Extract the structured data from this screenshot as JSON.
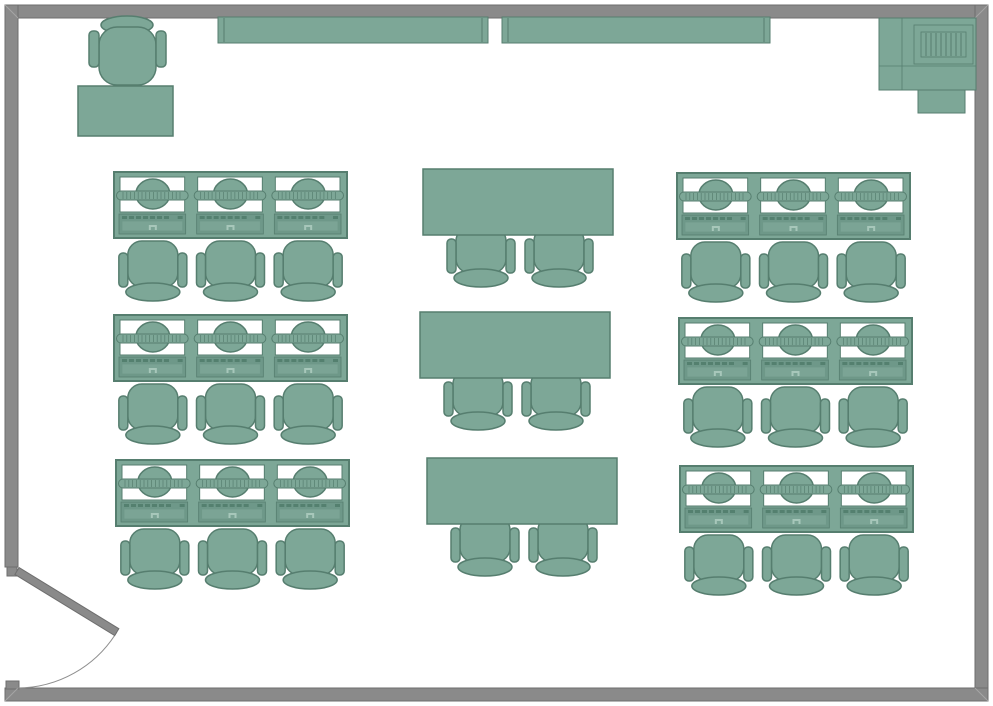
{
  "diagram": {
    "type": "floor-plan",
    "name": "computer-classroom-floor-plan"
  },
  "canvas": {
    "width": 993,
    "height": 706,
    "background": "#ffffff"
  },
  "colors": {
    "furniture_fill": "#7DA797",
    "furniture_stroke": "#567E6F",
    "keyboard_fill": "#6E9889",
    "keyboard_inner_fill": "#7BA495",
    "key_dash": "#54806F",
    "mouse_glyph": "#A7C7BA",
    "monitor_white": "#FFFFFF",
    "wall_fill": "#8A8A8A",
    "wall_stroke": "#6E6E6E",
    "wall_miter": "#A5A5A5",
    "swing_arc": "#8F8F8F"
  },
  "room": {
    "walls": [
      {
        "name": "wall-top",
        "x": 5,
        "y": 5,
        "w": 983,
        "h": 13
      },
      {
        "name": "wall-left",
        "x": 5,
        "y": 5,
        "w": 13,
        "h": 562
      },
      {
        "name": "wall-right",
        "x": 975,
        "y": 5,
        "w": 13,
        "h": 696
      },
      {
        "name": "wall-bottom",
        "x": 5,
        "y": 688,
        "w": 983,
        "h": 13
      }
    ],
    "jambs": [
      {
        "name": "door-jamb-top",
        "x": 7,
        "y": 567,
        "w": 10,
        "h": 9
      },
      {
        "name": "door-jamb-bottom",
        "x": 6,
        "y": 681,
        "w": 13,
        "h": 8
      }
    ],
    "miters": [
      {
        "x1": 5,
        "y1": 5,
        "x2": 18,
        "y2": 18
      },
      {
        "x1": 988,
        "y1": 5,
        "x2": 975,
        "y2": 18
      },
      {
        "x1": 988,
        "y1": 701,
        "x2": 975,
        "y2": 688
      },
      {
        "x1": 5,
        "y1": 701,
        "x2": 18,
        "y2": 688
      }
    ]
  },
  "door": {
    "hinge_x": 17,
    "hinge_y": 571,
    "length": 117,
    "thickness": 8,
    "angle_deg": 31.5
  },
  "whiteboards": [
    {
      "x": 218,
      "y": 17,
      "w": 270,
      "h": 26,
      "end_inset": 6
    },
    {
      "x": 502,
      "y": 17,
      "w": 268,
      "h": 26,
      "end_inset": 6
    }
  ],
  "printer": {
    "body": {
      "x": 879,
      "y": 18,
      "w": 97,
      "h": 72
    },
    "divider_x": 902,
    "divider_y": 66,
    "grille_outer": {
      "x": 914,
      "y": 25,
      "w": 59,
      "h": 39
    },
    "grille_inner": {
      "x": 921,
      "y": 32,
      "w": 45,
      "h": 25
    },
    "grille_stripes": 8,
    "tab": {
      "x": 918,
      "y": 90,
      "w": 47,
      "h": 23
    }
  },
  "teacher_station": {
    "chair": {
      "back": {
        "cx": 127,
        "cy": 25,
        "rx": 26,
        "ry": 9
      },
      "seat": {
        "x": 99,
        "y": 27,
        "w": 57,
        "h": 58,
        "r": 18
      },
      "arm_left": {
        "x": 89,
        "y": 31,
        "w": 10,
        "h": 36
      },
      "arm_right": {
        "x": 156,
        "y": 31,
        "w": 10,
        "h": 36
      }
    },
    "desk": {
      "x": 78,
      "y": 86,
      "w": 95,
      "h": 50
    }
  },
  "computer_desks": {
    "desk_w": 233,
    "desk_h": 66,
    "stations": 3,
    "rows": [
      {
        "x": 114,
        "y": 172
      },
      {
        "x": 114,
        "y": 315
      },
      {
        "x": 116,
        "y": 460
      },
      {
        "x": 677,
        "y": 173
      },
      {
        "x": 679,
        "y": 318
      },
      {
        "x": 680,
        "y": 466
      }
    ]
  },
  "tables": {
    "w": 190,
    "h": 66,
    "chair_center_offsets": [
      58,
      136
    ],
    "rows": [
      {
        "x": 423,
        "y": 169
      },
      {
        "x": 420,
        "y": 312
      },
      {
        "x": 427,
        "y": 458
      }
    ]
  },
  "chair_geometry": {
    "seat_w": 50,
    "seat_h": 46,
    "seat_r": 14,
    "arm_w": 9,
    "arm_h": 34,
    "arm_r": 4,
    "back_rx": 27,
    "back_ry": 9,
    "gap_below_desk": 3,
    "table_overlap": 8
  }
}
